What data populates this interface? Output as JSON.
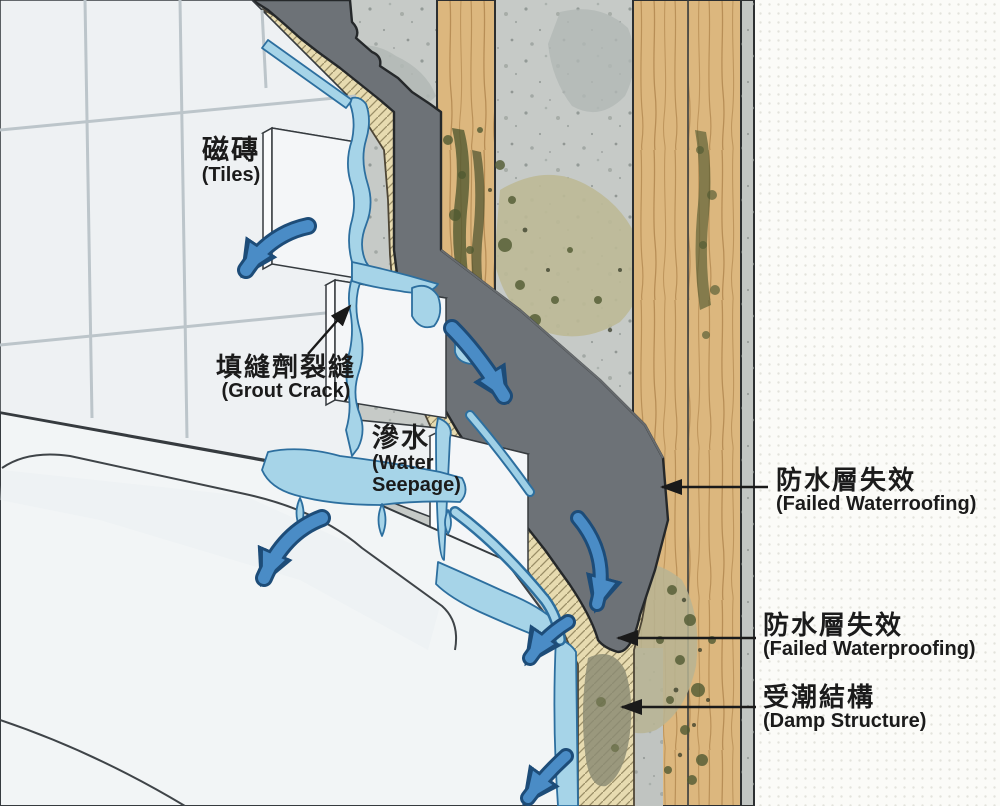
{
  "labels": {
    "tiles": {
      "zh": "磁磚",
      "en": "(Tiles)"
    },
    "grout_crack": {
      "zh": "填縫劑裂縫",
      "en": "(Grout Crack)"
    },
    "water_seepage": {
      "zh": "滲水",
      "en_line1": "(Water",
      "en_line2": "Seepage)"
    },
    "failed_waterproofing_upper": {
      "zh": "防水層失效",
      "en": "(Failed Waterroofing)"
    },
    "failed_waterproofing_lower": {
      "zh": "防水層失效",
      "en": "(Failed Waterproofing)"
    },
    "damp_structure": {
      "zh": "受潮結構",
      "en": "(Damp Structure)"
    }
  },
  "palette": {
    "tile": "#eef1f3",
    "grout_line": "#bcc5ca",
    "substrate_tan": "#e7dbb0",
    "membrane_gray": "#6d7277",
    "wood": "#dcb77e",
    "concrete": "#c6cac7",
    "mold_olive": "#515a32",
    "stain_tan": "#bdb996",
    "water_light": "#a6d4e8",
    "water_arrow_blue": "#4183bd",
    "leader_black": "#1a1a1a",
    "panel_background": "#fbfbf8",
    "text": "#1b1b1b"
  }
}
